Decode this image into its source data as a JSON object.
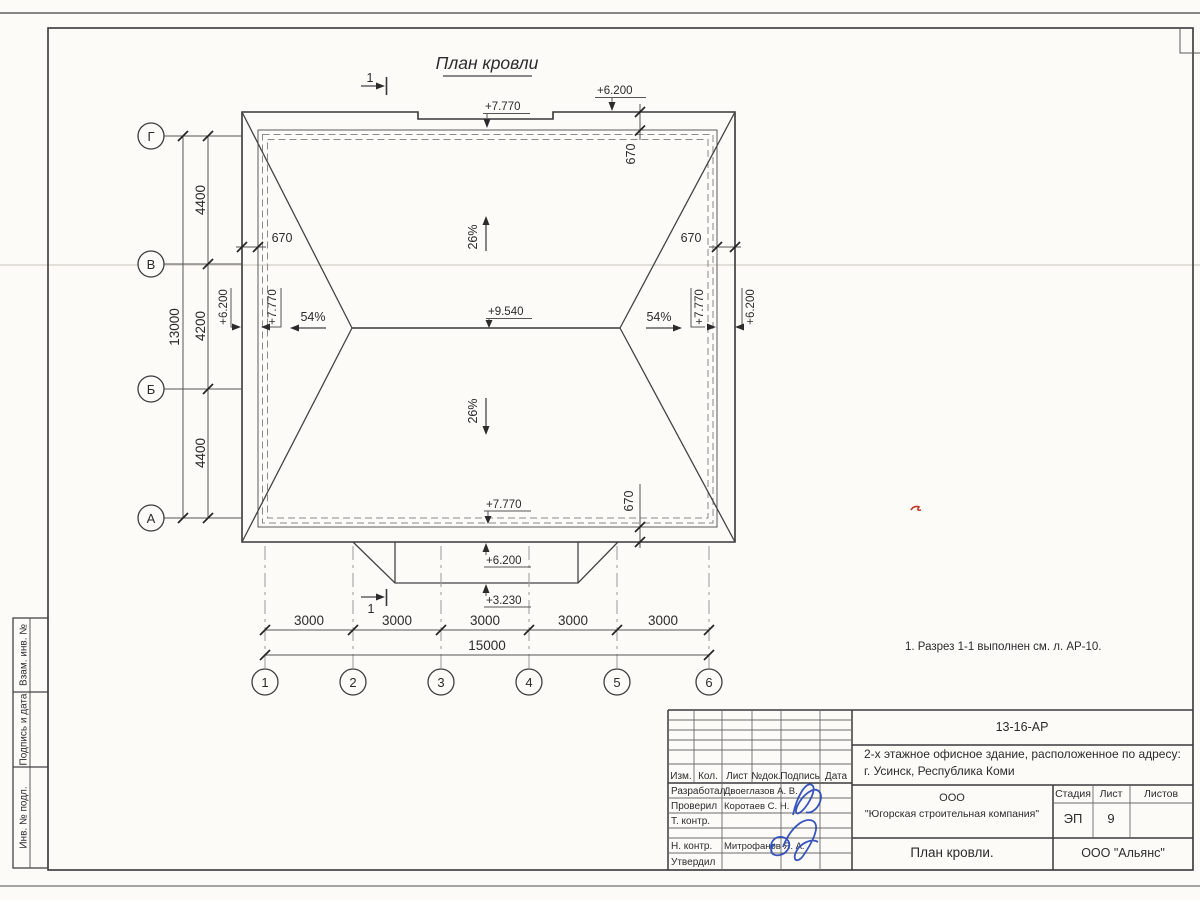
{
  "page": {
    "title": "План кровли",
    "note": "1. Разрез 1-1 выполнен см. л. АР-10."
  },
  "plan": {
    "section": "1",
    "axes_left": [
      "Г",
      "В",
      "Б",
      "А"
    ],
    "axes_bottom": [
      "1",
      "2",
      "3",
      "4",
      "5",
      "6"
    ],
    "dims_left": [
      "4400",
      "4200",
      "4400"
    ],
    "dim_left_total": "13000",
    "dims_bottom": [
      "3000",
      "3000",
      "3000",
      "3000",
      "3000"
    ],
    "dim_bottom_total": "15000",
    "overhangs": [
      "670",
      "670",
      "670",
      "670"
    ],
    "elevations": {
      "top_notch": "+7.770",
      "top_eave": "+6.200",
      "ridge": "+9.540",
      "left_eave": "+6.200",
      "left_wall": "+7.770",
      "right_wall": "+7.770",
      "right_eave": "+6.200",
      "bottom_wall": "+7.770",
      "canopy": "+6.200",
      "canopy_edge": "+3.230"
    },
    "slopes": {
      "north": "26%",
      "south": "26%",
      "west": "54%",
      "east": "54%"
    }
  },
  "titleblock": {
    "doc_number": "13-16-АР",
    "project_line1": "2-х этажное офисное здание, расположенное по адресу:",
    "project_line2": "г. Усинск, Республика Коми",
    "header_cols": [
      "Изм.",
      "Кол.",
      "Лист",
      "№док.",
      "Подпись",
      "Дата"
    ],
    "rows": [
      {
        "role": "Разработал",
        "name": "Двоеглазов А. В."
      },
      {
        "role": "Проверил",
        "name": "Коротаев С. Н."
      },
      {
        "role": "Т. контр.",
        "name": ""
      },
      {
        "role": "Н. контр.",
        "name": "Митрофанов Я. А."
      },
      {
        "role": "Утвердил",
        "name": ""
      }
    ],
    "company_line1": "ООО",
    "company_line2": "\"Югорская строительная компания\"",
    "stage_label": "Стадия",
    "sheet_label": "Лист",
    "sheets_label": "Листов",
    "stage": "ЭП",
    "sheet": "9",
    "sheets": "",
    "sheet_title": "План кровли.",
    "org": "ООО \"Альянс\""
  },
  "sidebar": [
    "Взам. инв. №",
    "Подпись и дата",
    "Инв. № подл."
  ]
}
